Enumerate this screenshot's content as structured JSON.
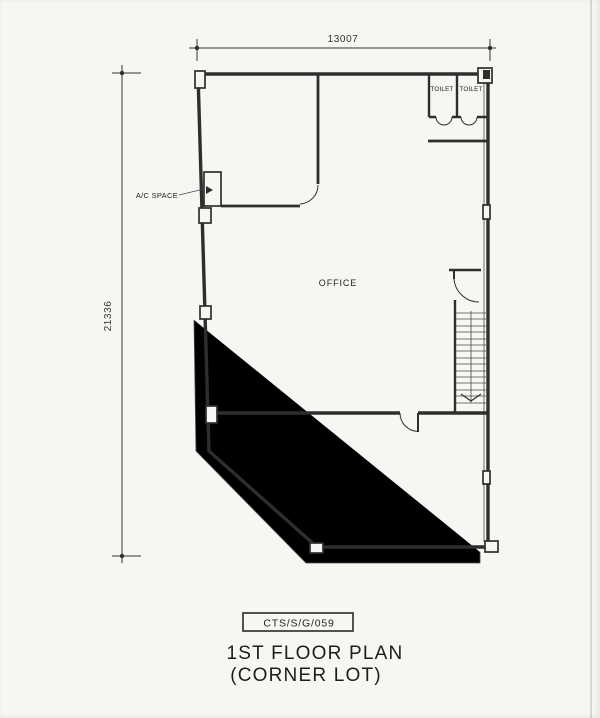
{
  "dimensions": {
    "top": "13007",
    "left": "21336"
  },
  "rooms": {
    "office": "OFFICE",
    "ac_space": "A/C SPACE",
    "toilet_left": "TOILET",
    "toilet_right": "TOILET"
  },
  "footer": {
    "ref_code": "CTS/S/G/059",
    "title_line1": "1ST FLOOR PLAN",
    "title_line2": "(CORNER LOT)"
  },
  "colors": {
    "ink": "#2e2e2e",
    "paper": "#f6f6f3"
  }
}
